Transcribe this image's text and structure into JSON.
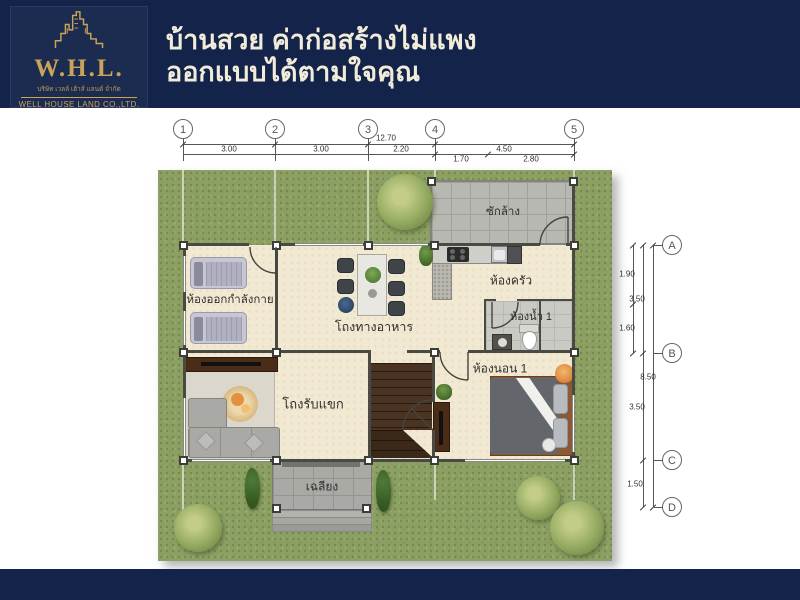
{
  "header": {
    "logo": {
      "abbr": "W.H.L.",
      "company_th": "บริษัท เวลล์ เฮ้าส์ แลนด์ จำกัด",
      "company_en": "WELL HOUSE LAND CO.,LTD.",
      "icon": "building-skyline-icon"
    },
    "title_line1": "บ้านสวย ค่าก่อสร้างไม่แพง",
    "title_line2": "ออกแบบได้ตามใจคุณ"
  },
  "floor_plan": {
    "grid": {
      "columns": [
        "1",
        "2",
        "3",
        "4",
        "5"
      ],
      "rows": [
        "A",
        "B",
        "C",
        "D"
      ]
    },
    "dimensions": {
      "top_spans": [
        "3.00",
        "3.00",
        "2.20",
        "4.50"
      ],
      "top_total": "12.70",
      "top_sub_spans": [
        "1.70",
        "2.80"
      ],
      "right_sub_spans": [
        "1.90",
        "1.60"
      ],
      "right_spans": [
        "3.50",
        "3.50",
        "1.50"
      ],
      "right_total": "8.50"
    },
    "rooms": [
      {
        "id": "laundry",
        "label": "ซักล้าง"
      },
      {
        "id": "kitchen",
        "label": "ห้องครัว"
      },
      {
        "id": "bathroom-1",
        "label": "ห้องน้ำ 1"
      },
      {
        "id": "bedroom-1",
        "label": "ห้องนอน 1"
      },
      {
        "id": "exercise-room",
        "label": "ห้องออกกำลังกาย"
      },
      {
        "id": "dining-hall",
        "label": "โถงทางอาหาร"
      },
      {
        "id": "living-hall",
        "label": "โถงรับแขก"
      },
      {
        "id": "porch",
        "label": "เฉลียง"
      }
    ],
    "colors": {
      "navy": "#14234a",
      "gold": "#c9a459",
      "cream_text": "#f1ecda",
      "grass": "#8ca064",
      "floor": "#f2e9d3",
      "tile_gray": "#b7b8b1"
    }
  }
}
